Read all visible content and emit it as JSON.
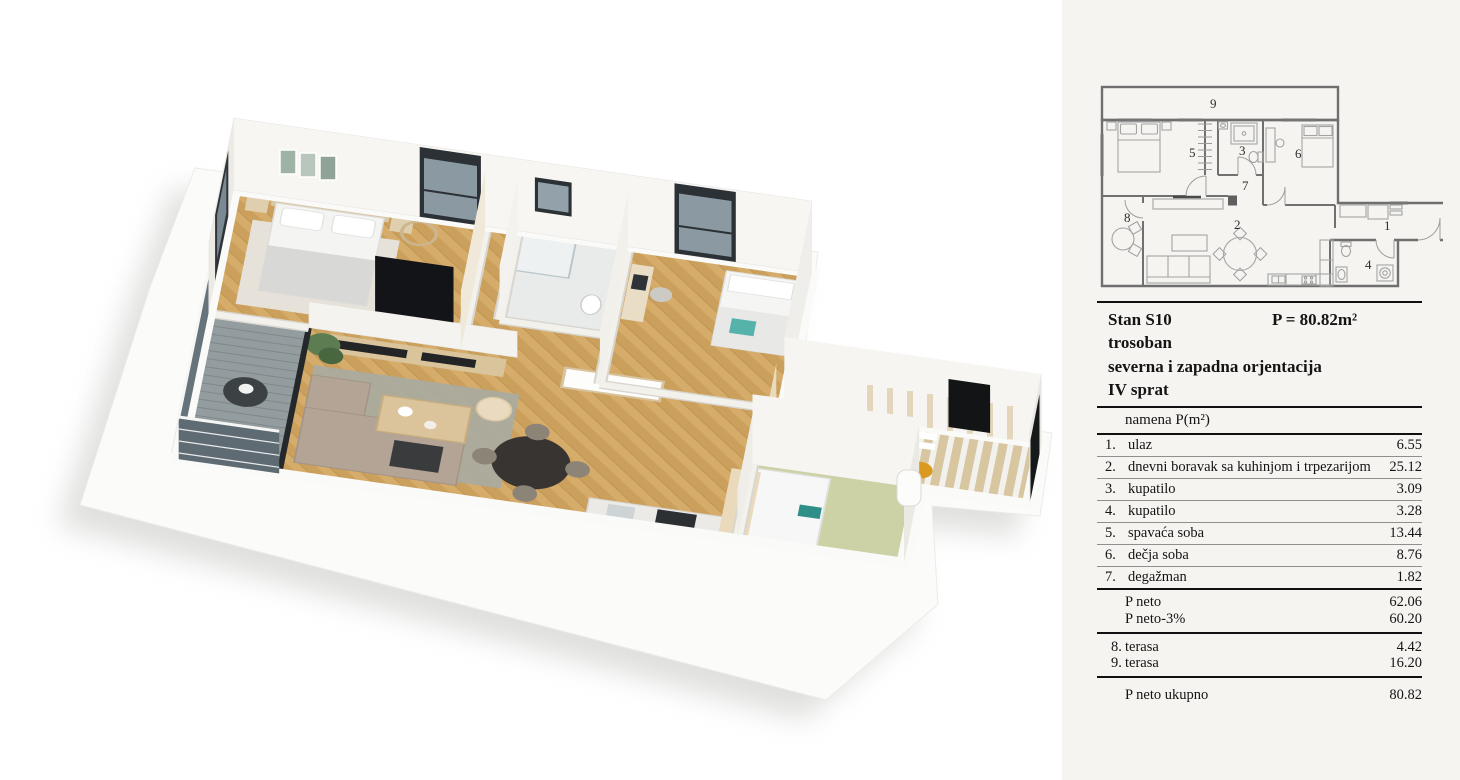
{
  "panel": {
    "title": "Stan S10",
    "area_total_label": "P = 80.82m²",
    "type_label": "trosoban",
    "orientation_label": "severna i zapadna orjentacija",
    "floor_label": "IV sprat",
    "table": {
      "header": {
        "name": "namena",
        "area": "P(m²)"
      },
      "rooms": [
        {
          "num": "1.",
          "name": "ulaz",
          "area": "6.55"
        },
        {
          "num": "2.",
          "name": "dnevni boravak sa kuhinjom i trpezarijom",
          "area": "25.12"
        },
        {
          "num": "3.",
          "name": "kupatilo",
          "area": "3.09"
        },
        {
          "num": "4.",
          "name": "kupatilo",
          "area": "3.28"
        },
        {
          "num": "5.",
          "name": "spavaća soba",
          "area": "13.44"
        },
        {
          "num": "6.",
          "name": "dečja soba",
          "area": "8.76"
        },
        {
          "num": "7.",
          "name": "degažman",
          "area": "1.82"
        }
      ],
      "neto": {
        "label": "P neto",
        "value": "62.06"
      },
      "neto_minus": {
        "label": "P neto-3%",
        "value": "60.20"
      },
      "terraces": [
        {
          "num": "8.",
          "name": "terasa",
          "area": "4.42"
        },
        {
          "num": "9.",
          "name": "terasa",
          "area": "16.20"
        }
      ],
      "total": {
        "label": "P neto ukupno",
        "value": "80.82"
      }
    }
  },
  "plan2d": {
    "room_numbers": {
      "r1": "1",
      "r2": "2",
      "r3": "3",
      "r4": "4",
      "r5": "5",
      "r6": "6",
      "r7": "7",
      "r8": "8",
      "r9": "9"
    }
  },
  "colors": {
    "wood_floor": "#cb9f5c",
    "panel_bg": "#f5f4f1",
    "wall_white": "#f7f6f3",
    "accent_teal": "#56b3ab",
    "accent_mustard": "#d99a1f"
  }
}
